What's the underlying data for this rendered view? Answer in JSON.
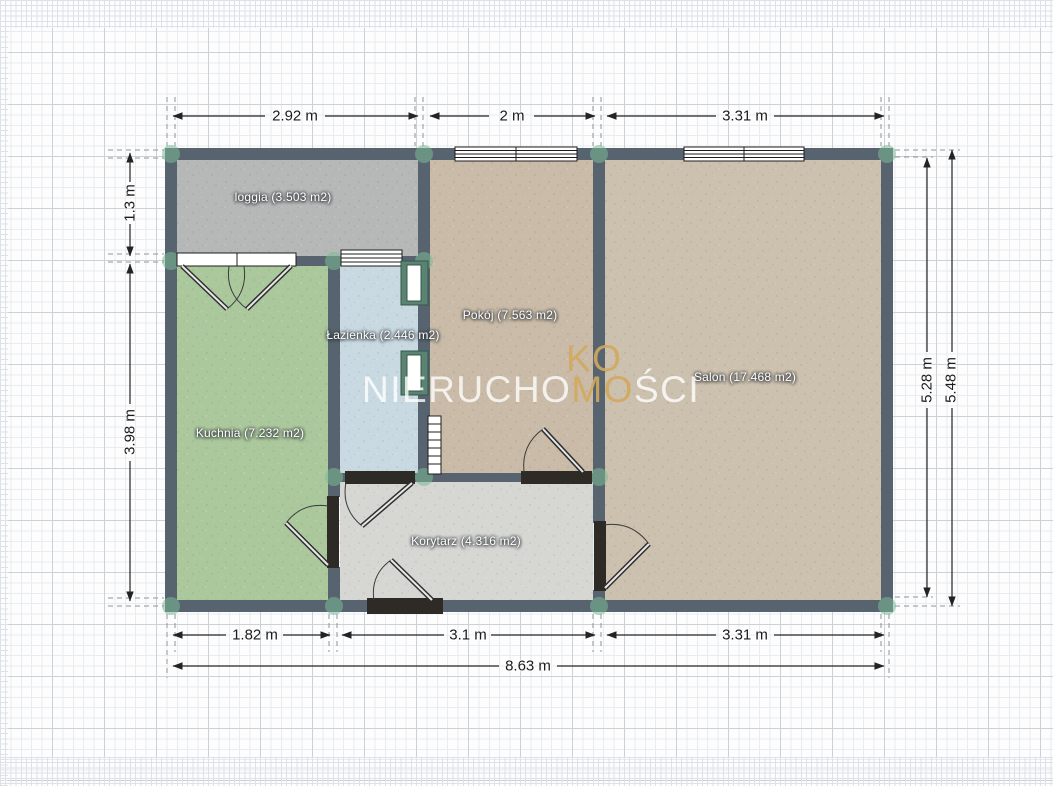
{
  "floorplan": {
    "rooms": [
      {
        "id": "loggia",
        "label": "loggia (3.503 m2)"
      },
      {
        "id": "kuchnia",
        "label": "Kuchnia (7.232 m2)"
      },
      {
        "id": "lazienka",
        "label": "Łazienka (2.446 m2)"
      },
      {
        "id": "pokoj",
        "label": "Pokój (7.563 m2)"
      },
      {
        "id": "salon",
        "label": "Salon (17.468 m2)"
      },
      {
        "id": "korytarz",
        "label": "Korytarz (4.316 m2)"
      }
    ]
  },
  "dimensions": {
    "top": [
      "2.92 m",
      "2 m",
      "3.31 m"
    ],
    "bottom": [
      "1.82 m",
      "3.1 m",
      "3.31 m"
    ],
    "bottom_total": "8.63 m",
    "left": [
      "1.3 m",
      "3.98 m"
    ],
    "right": [
      "5.28 m",
      "5.48 m"
    ]
  },
  "watermark": {
    "logo_top": "KO",
    "text_left": "NIERUCHO",
    "text_gold": "MO",
    "text_right": "ŚCI"
  },
  "colors": {
    "wall": "#57646f",
    "loggia_floor": "#b5b8b6",
    "kuchnia_floor": "#abc89d",
    "lazienka_floor": "#c9d9e1",
    "pokoj_floor": "#c9bba7",
    "salon_floor": "#ccc0ae",
    "korytarz_floor": "#d6d6d3",
    "corner_accent": "#7cba96",
    "door_dark": "#2e2a26",
    "niche_frame": "#5b8371",
    "watermark_gold": "#d2a95d"
  }
}
